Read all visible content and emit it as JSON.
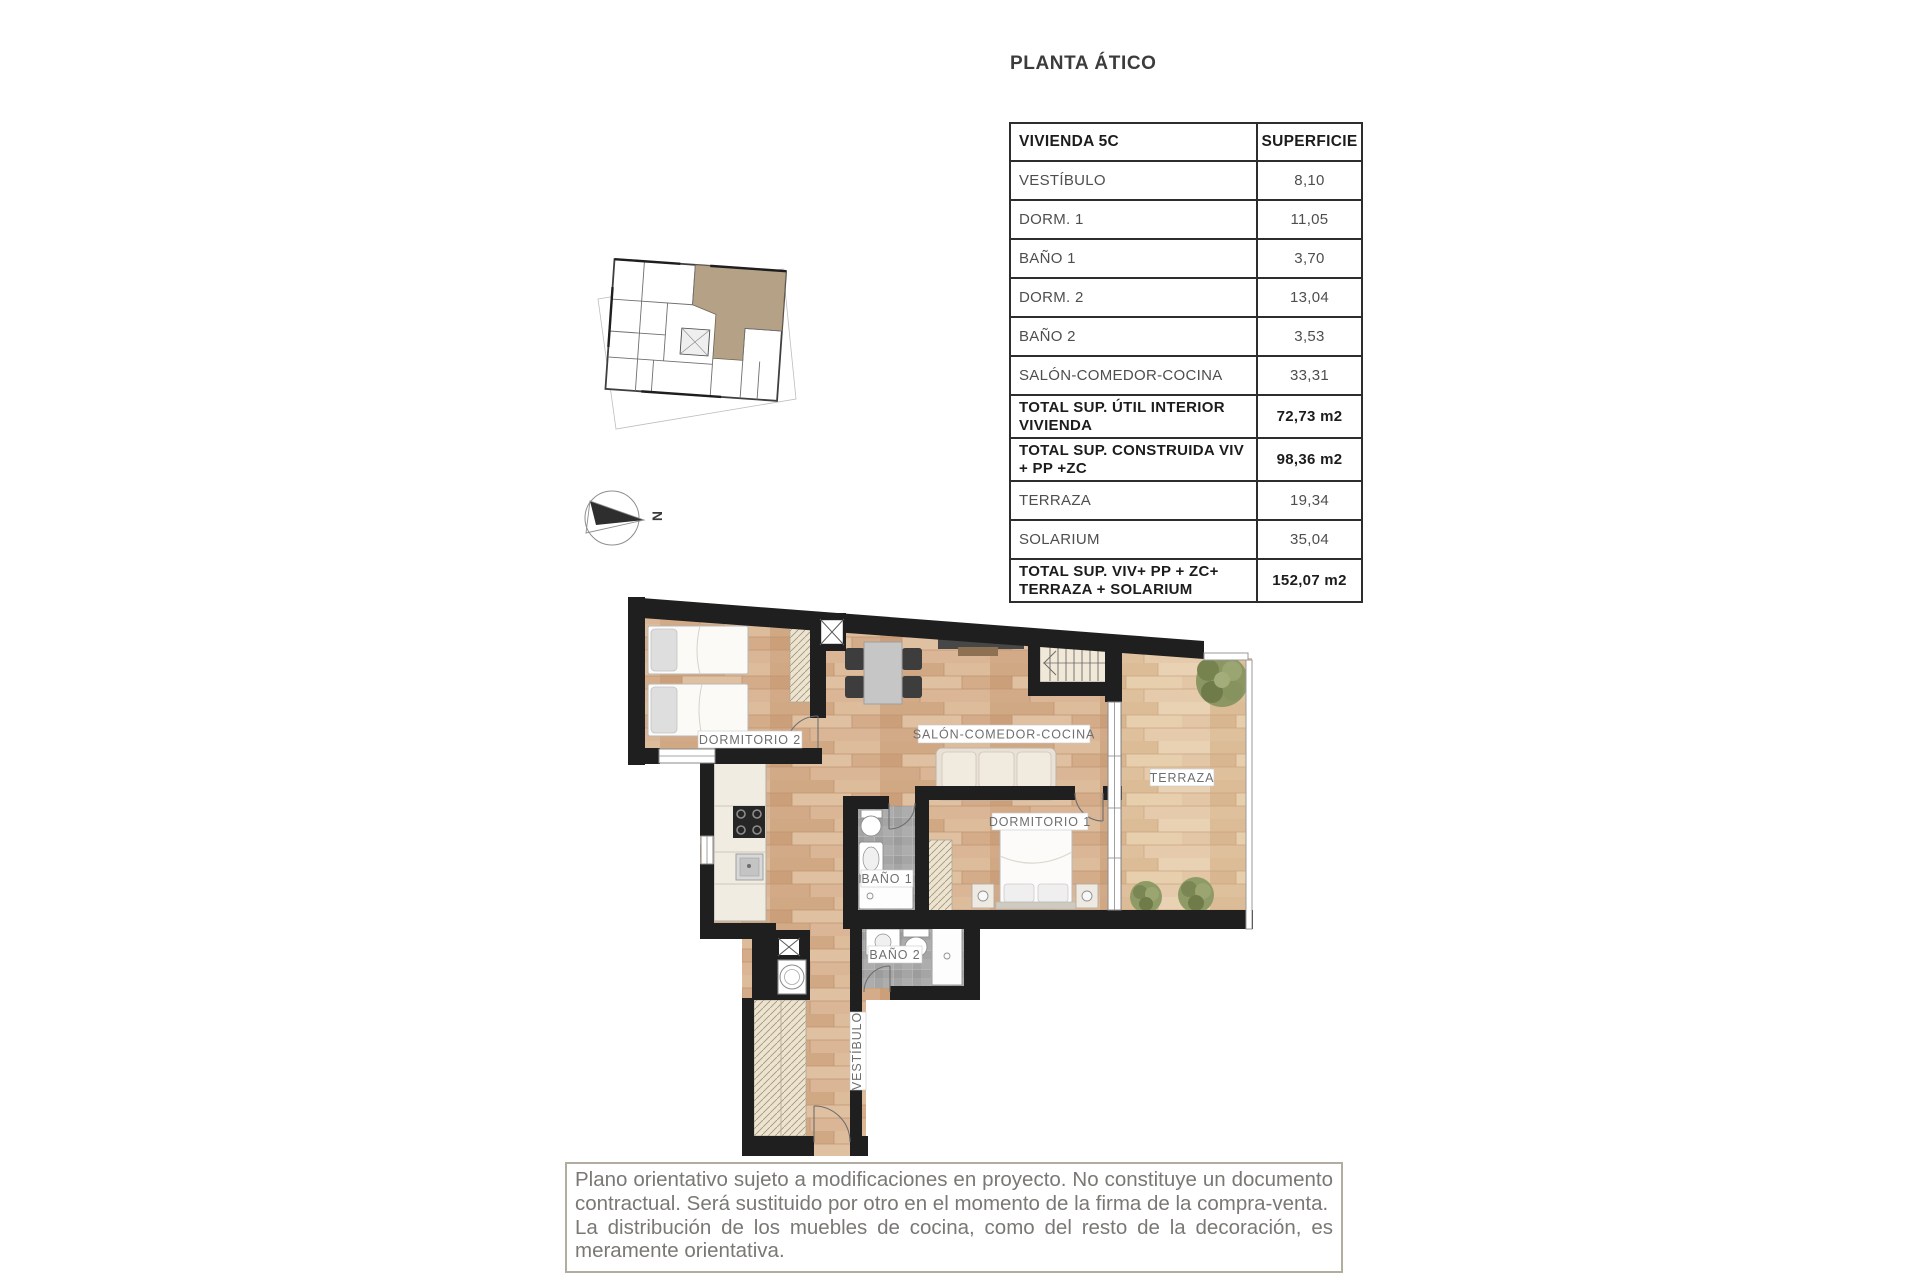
{
  "title": "PLANTA ÁTICO",
  "table": {
    "header": {
      "col1": "VIVIENDA 5C",
      "col2": "SUPERFICIE"
    },
    "rows": [
      {
        "label": "VESTÍBULO",
        "value": "8,10",
        "bold": false
      },
      {
        "label": "DORM. 1",
        "value": "11,05",
        "bold": false
      },
      {
        "label": "BAÑO 1",
        "value": "3,70",
        "bold": false
      },
      {
        "label": "DORM. 2",
        "value": "13,04",
        "bold": false
      },
      {
        "label": "BAÑO 2",
        "value": "3,53",
        "bold": false
      },
      {
        "label": "SALÓN-COMEDOR-COCINA",
        "value": "33,31",
        "bold": false
      },
      {
        "label": "TOTAL SUP. ÚTIL INTERIOR VIVIENDA",
        "value": "72,73 m2",
        "bold": true
      },
      {
        "label": "TOTAL SUP. CONSTRUIDA VIV + PP +ZC",
        "value": "98,36 m2",
        "bold": true
      },
      {
        "label": "TERRAZA",
        "value": "19,34",
        "bold": false
      },
      {
        "label": "SOLARIUM",
        "value": "35,04",
        "bold": false
      },
      {
        "label": "TOTAL SUP. VIV+ PP + ZC+ TERRAZA + SOLARIUM",
        "value": "152,07 m2",
        "bold": true
      }
    ]
  },
  "plan": {
    "rooms": {
      "dorm2": "DORMITORIO 2",
      "salon": "SALÓN-COMEDOR-COCINA",
      "dorm1": "DORMITORIO 1",
      "terraza": "TERRAZA",
      "bano1": "BAÑO 1",
      "bano2": "BAÑO 2",
      "vestibulo": "VESTÍBULO"
    }
  },
  "compass": {
    "north": "N"
  },
  "disclaimer": {
    "p1": "Plano orientativo sujeto a modificaciones en proyecto. No constituye un documento contractual. Será sustituido por otro en el momento de la firma de la compra-venta.",
    "p2": "La distribución de los muebles de cocina, como del resto de la decoración, es meramente orientativa."
  },
  "colors": {
    "wall": "#1f1f1f",
    "wood": "#d7b293",
    "terrace_wood": "#e2c6a6",
    "tile": "#a5a5a5",
    "unit_highlight": "#b5a186",
    "disclaimer_border": "#b2ad9f"
  }
}
